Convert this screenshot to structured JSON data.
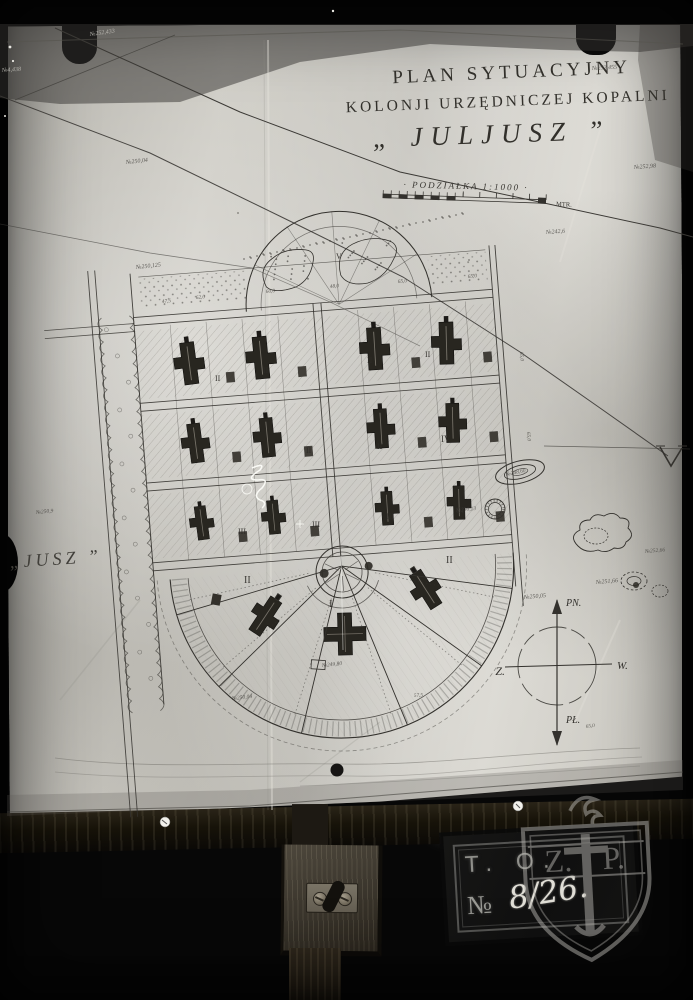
{
  "title": {
    "line1": "PLAN SYTUACYJNY",
    "line2": "KOLONJI URZĘDNICZEJ KOPALNI",
    "line3": "„ JULJUSZ ”"
  },
  "scale": {
    "label": "· PODZIAŁKA 1:1000 ·",
    "unit": "MTR."
  },
  "edge_label": "„JUSZ ”",
  "compass": {
    "north": "PN.",
    "south": "PŁ.",
    "east": "W.",
    "west": "Z."
  },
  "stamp": {
    "line1": "T. O.",
    "number_prefix": "№",
    "number": "8/26.",
    "watermark_left": "Z.",
    "watermark_right": "P."
  },
  "plan": {
    "numerals": [
      {
        "t": "V",
        "x": 336,
        "y": 259,
        "s": 8
      },
      {
        "t": "II",
        "x": 215,
        "y": 381,
        "s": 8
      },
      {
        "t": "II",
        "x": 263,
        "y": 373,
        "s": 8
      },
      {
        "t": "II",
        "x": 367,
        "y": 363,
        "s": 8
      },
      {
        "t": "II",
        "x": 425,
        "y": 357,
        "s": 8
      },
      {
        "t": "II",
        "x": 306,
        "y": 453,
        "s": 8
      },
      {
        "t": "II",
        "x": 377,
        "y": 449,
        "s": 8
      },
      {
        "t": "IV",
        "x": 441,
        "y": 442,
        "s": 9
      },
      {
        "t": "III",
        "x": 238,
        "y": 534,
        "s": 8
      },
      {
        "t": "III",
        "x": 312,
        "y": 527,
        "s": 8
      },
      {
        "t": "III",
        "x": 386,
        "y": 519,
        "s": 8
      },
      {
        "t": "III",
        "x": 456,
        "y": 513,
        "s": 8
      },
      {
        "t": "II",
        "x": 244,
        "y": 583,
        "s": 10
      },
      {
        "t": "II",
        "x": 446,
        "y": 563,
        "s": 10
      },
      {
        "t": "I",
        "x": 329,
        "y": 607,
        "s": 11
      }
    ],
    "annotations": [
      {
        "t": "№252,455",
        "x": 592,
        "y": 70,
        "rot": -3
      },
      {
        "t": "№252,433",
        "x": 90,
        "y": 36,
        "rot": -8,
        "light": true
      },
      {
        "t": "№4,438",
        "x": 2,
        "y": 72,
        "rot": -4,
        "light": true
      },
      {
        "t": "№250,04",
        "x": 126,
        "y": 164,
        "rot": -6
      },
      {
        "t": "№250,125",
        "x": 136,
        "y": 269,
        "rot": -6
      },
      {
        "t": "№242,6",
        "x": 546,
        "y": 234,
        "rot": -4
      },
      {
        "t": "№252,98",
        "x": 634,
        "y": 169,
        "rot": -4
      },
      {
        "t": "№248,60",
        "x": 506,
        "y": 476,
        "s": 5.5,
        "rot": -12
      },
      {
        "t": "№250,13",
        "x": 456,
        "y": 512,
        "s": 5.5,
        "rot": -6
      },
      {
        "t": "№251,66",
        "x": 596,
        "y": 584,
        "rot": -5
      },
      {
        "t": "№250,05",
        "x": 524,
        "y": 599,
        "rot": -5
      },
      {
        "t": "№252,66",
        "x": 645,
        "y": 553,
        "s": 5.5,
        "rot": -5
      },
      {
        "t": "№249,80",
        "x": 322,
        "y": 667,
        "s": 5.5,
        "rot": -6
      },
      {
        "t": "№250,04",
        "x": 232,
        "y": 700,
        "s": 5.5,
        "rot": -6
      },
      {
        "t": "№250,9",
        "x": 36,
        "y": 514,
        "s": 5.5,
        "rot": -6
      }
    ],
    "dimensions": [
      {
        "t": "47,5",
        "x": 162,
        "y": 303,
        "rot": -5
      },
      {
        "t": "62,0",
        "x": 196,
        "y": 299,
        "rot": -5
      },
      {
        "t": "60,0",
        "x": 266,
        "y": 293,
        "rot": -5
      },
      {
        "t": "48,0",
        "x": 330,
        "y": 288,
        "rot": -5
      },
      {
        "t": "65,0",
        "x": 398,
        "y": 283,
        "rot": -5
      },
      {
        "t": "65,0",
        "x": 468,
        "y": 278,
        "rot": -5
      },
      {
        "t": "65,0",
        "x": 520,
        "y": 352,
        "rot": 86
      },
      {
        "t": "65,0",
        "x": 527,
        "y": 432,
        "rot": 86
      },
      {
        "t": "57,5",
        "x": 414,
        "y": 697,
        "rot": -4
      },
      {
        "t": "65,0",
        "x": 586,
        "y": 728,
        "rot": -8
      }
    ]
  },
  "colors": {
    "photo_background": "#070707",
    "paper": "#c6c4bd",
    "ink": "#33312d",
    "shadow_band": "#605e59",
    "wood_dark": "#1a160f",
    "stamp_plate": "#121211",
    "stamp_text": "#95958f",
    "stamp_number": "#e3e1da",
    "watermark": "#b5b3ae"
  }
}
